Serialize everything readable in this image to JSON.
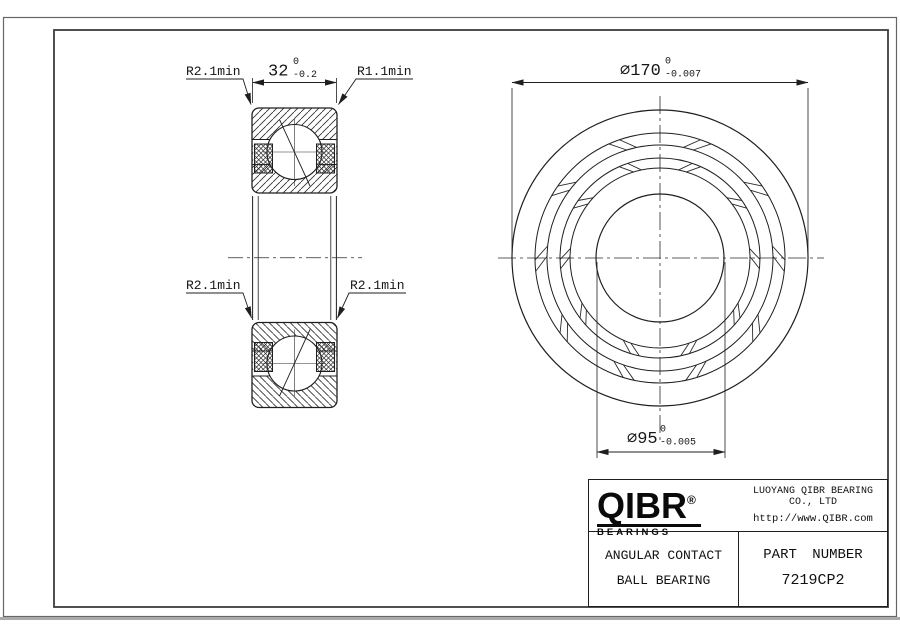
{
  "section_view": {
    "label_top_left": "R2.1min",
    "label_top_right": "R1.1min",
    "label_mid_left": "R2.1min",
    "label_mid_right": "R2.1min",
    "width_dim": {
      "value": "32",
      "tol_upper": "0",
      "tol_lower": "-0.2"
    }
  },
  "front_view": {
    "od_dim": {
      "value": "∅170",
      "tol_upper": "0",
      "tol_lower": "-0.007"
    },
    "bore_dim": {
      "value": "∅95",
      "tol_upper": "0",
      "tol_lower": "-0.005"
    }
  },
  "title_block": {
    "logo_text": "QIBR",
    "logo_registered": "®",
    "logo_sub": "BEARINGS",
    "company": "LUOYANG QIBR BEARING CO., LTD",
    "website": "http://www.QIBR.com",
    "product_line1": "ANGULAR CONTACT",
    "product_line2": "BALL BEARING",
    "part_number_label": "PART NUMBER",
    "part_number": "7219CP2"
  },
  "colors": {
    "line": "#1f1f1f",
    "frame": "#444444",
    "background": "#ffffff"
  }
}
